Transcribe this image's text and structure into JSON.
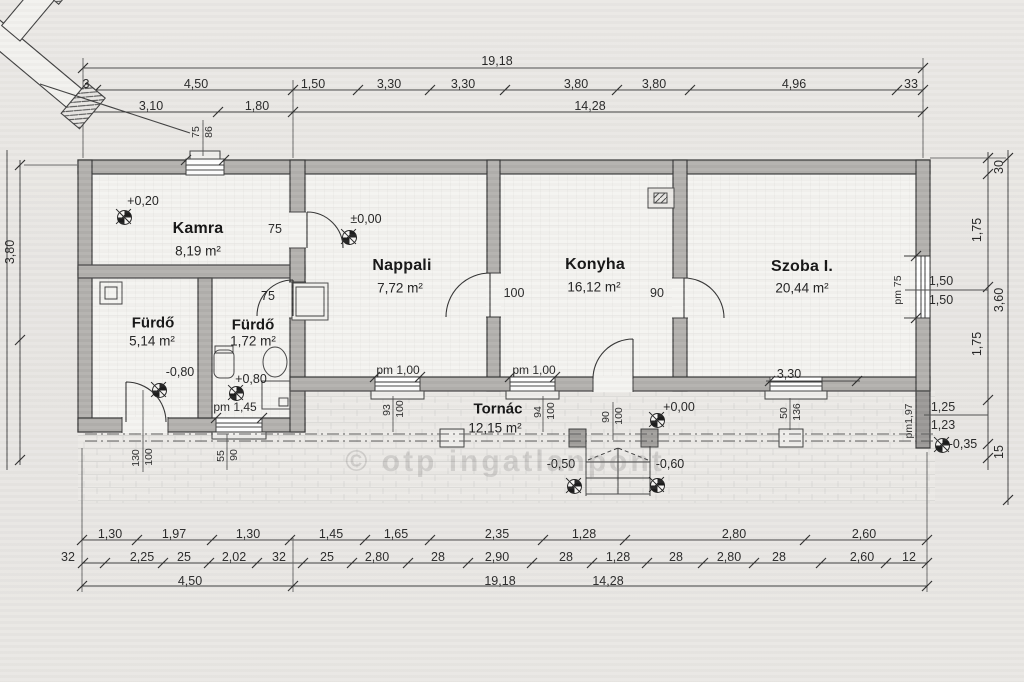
{
  "drawing": {
    "watermark": "© otp ingatlanpont",
    "rooms": {
      "kamra": {
        "name": "Kamra",
        "area": "8,19 m²"
      },
      "nappali": {
        "name": "Nappali",
        "area": "7,72 m²"
      },
      "konyha": {
        "name": "Konyha",
        "area": "16,12 m²"
      },
      "szoba": {
        "name": "Szoba I.",
        "area": "20,44 m²"
      },
      "furdo1": {
        "name": "Fürdő",
        "area": "5,14 m²"
      },
      "furdo2": {
        "name": "Fürdő",
        "area": "1,72 m²"
      },
      "tornac": {
        "name": "Tornác",
        "area": "12,15 m²"
      }
    },
    "levels": {
      "kamra": "+0,20",
      "nappali": "±0,00",
      "furdo1": "-0,80",
      "furdo2": "+0,80",
      "tornac": "+0,00",
      "steps_left": "-0,50",
      "steps_right": "-0,60",
      "east": "-0,35"
    },
    "dims": {
      "t1": [
        "19,18"
      ],
      "t2": [
        "3",
        "4,50",
        "1,50",
        "3,30",
        "3,30",
        "3,80",
        "3,80",
        "4,96",
        "33"
      ],
      "t3": [
        "3,10",
        "1,80",
        "14,28"
      ],
      "b1": [
        "1,30",
        "1,97",
        "1,30",
        "1,45",
        "1,65",
        "2,35",
        "1,28",
        "2,80",
        "2,60"
      ],
      "b2": [
        "32",
        "2,25",
        "25",
        "2,02",
        "32",
        "25",
        "2,80",
        "28",
        "2,90",
        "28",
        "1,28",
        "28",
        "2,80",
        "28",
        "2,60",
        "12"
      ],
      "b3": [
        "4,50",
        "19,18",
        "14,28"
      ],
      "left": [
        "3,80"
      ],
      "right": [
        "30",
        "1,75",
        "3,60",
        "1,75",
        "15"
      ]
    },
    "openings": {
      "kamra_win": [
        "75",
        "86"
      ],
      "door_kamra": "75",
      "door_furdo2": "75",
      "door_nk": "100",
      "door_ks": "90",
      "win_nappali": [
        "pm 1,00",
        "93",
        "100"
      ],
      "win_konyha": [
        "pm 1,00",
        "94",
        "100"
      ],
      "entrance": [
        "90",
        "100"
      ],
      "win_furdo2": [
        "pm 1,45",
        "55",
        "90"
      ],
      "door_furdo1": [
        "130",
        "100"
      ],
      "win_szoba_s": [
        "3,30",
        "50",
        "136"
      ],
      "win_szoba_e": [
        "pm 75",
        "1,50",
        "1,50"
      ],
      "corner_e": [
        "pm1,97",
        "1,25",
        "1,23"
      ]
    }
  }
}
